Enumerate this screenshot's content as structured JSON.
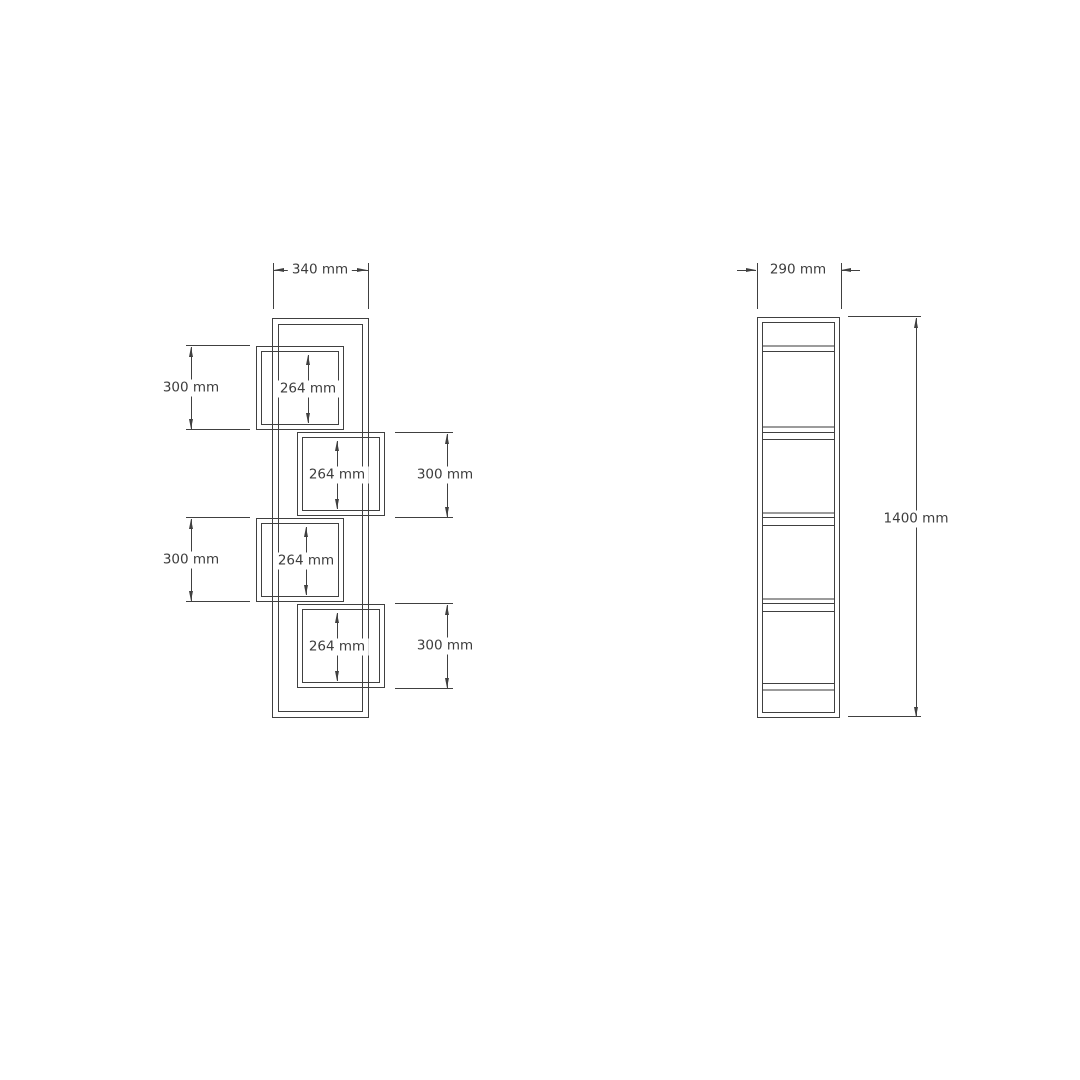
{
  "drawing": {
    "front_view": {
      "width_dim": "340 mm",
      "left_outer_dims": [
        "300 mm",
        "300 mm"
      ],
      "right_outer_dims": [
        "300 mm",
        "300 mm"
      ],
      "inner_dims": [
        "264 mm",
        "264 mm",
        "264 mm",
        "264 mm"
      ]
    },
    "side_view": {
      "depth_dim": "290 mm",
      "height_dim": "1400 mm"
    },
    "colors": {
      "line": "#404040",
      "panel_line": "#9b9b9b",
      "text": "#3d3d3d",
      "background": "#ffffff"
    }
  }
}
